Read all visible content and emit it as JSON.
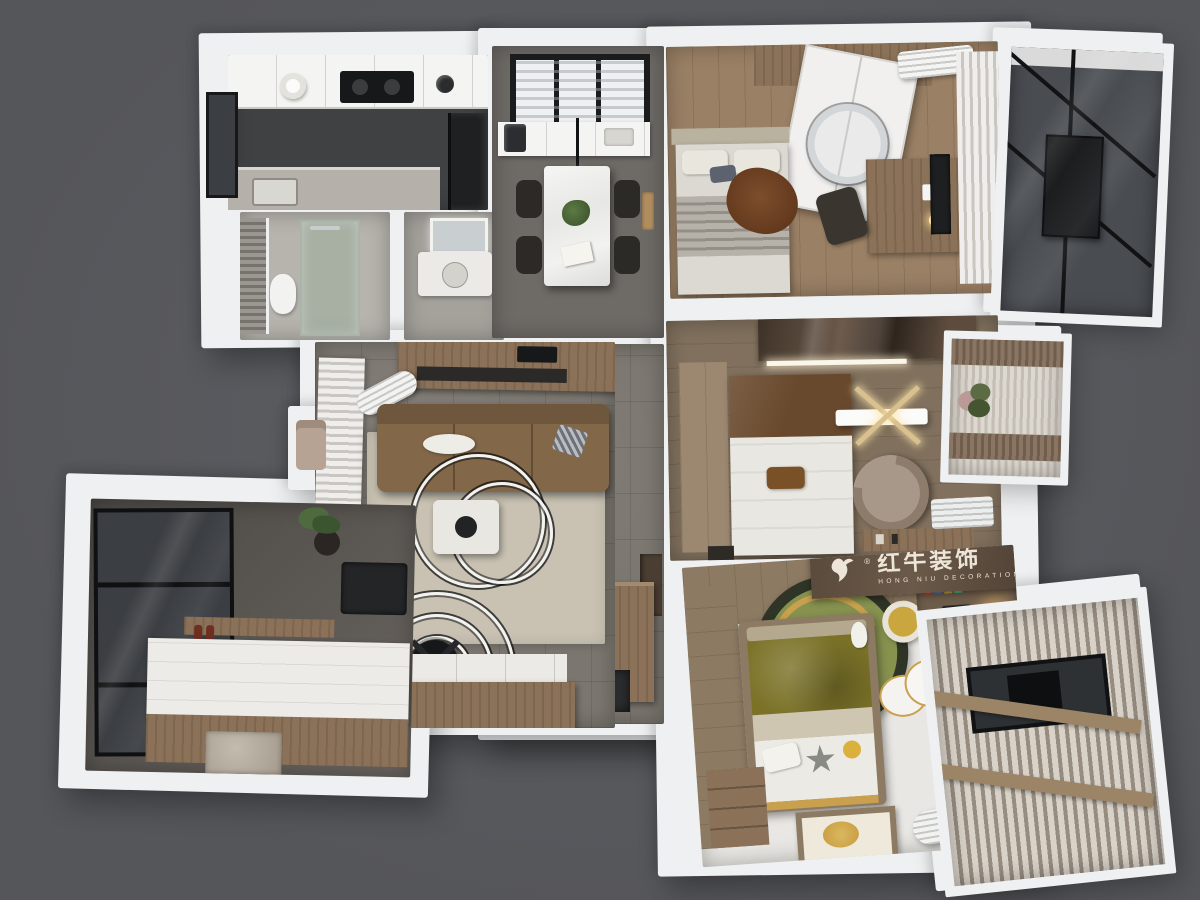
{
  "watermark": {
    "brand_cn": "红牛装饰",
    "brand_en": "HONG NIU DECORATION",
    "registered_mark": "®"
  },
  "palette": {
    "bg": "#55565a",
    "bglight": "#5d5e63",
    "wall": "#eef0f1",
    "white2": "#f4f4f2",
    "tile": "#7b766f",
    "tiledark": "#6e6a66",
    "wood": "#8a7158",
    "woodlight": "#9a8065",
    "wooddark": "#6e5c4a",
    "gloss1": "#3e3228",
    "gloss2": "#6b594a",
    "rug": "#c9c2b3",
    "sofa": "#826749",
    "sofaback": "#6f573d",
    "stone": "#55514d",
    "stonefloor": "#aaa198",
    "glassdark": "#3b3e42",
    "glasspane": "#494d52",
    "curtain": "#efeeec",
    "curtainshade": "#c9c6bf",
    "kitchenfloor": "#3f4143",
    "olive": "#7b7228",
    "kidsruggreen": "#87924f",
    "kidsrugdark": "#2f3526",
    "gold": "#c9a14e",
    "charcoal": "#1d1f21",
    "taupe": "#8d7c6b",
    "matbrown": "#3a2e26",
    "bandbrown": "#6b5a49",
    "bandtext": "#ece5d8",
    "bedwhite": "#e9e7e1",
    "headbrown": "#69492d",
    "throwbrown": "#6b4226"
  },
  "rooms": [
    {
      "id": "kitchen"
    },
    {
      "id": "bathroom-shower"
    },
    {
      "id": "bathroom-vanity"
    },
    {
      "id": "dining-room"
    },
    {
      "id": "hallway"
    },
    {
      "id": "living-room"
    },
    {
      "id": "study-tatami"
    },
    {
      "id": "balcony-bottom-left"
    },
    {
      "id": "bedroom-top-right"
    },
    {
      "id": "balcony-top-right"
    },
    {
      "id": "master-bedroom"
    },
    {
      "id": "bay-window"
    },
    {
      "id": "kids-room"
    },
    {
      "id": "kids-window-bay"
    },
    {
      "id": "entry"
    }
  ]
}
